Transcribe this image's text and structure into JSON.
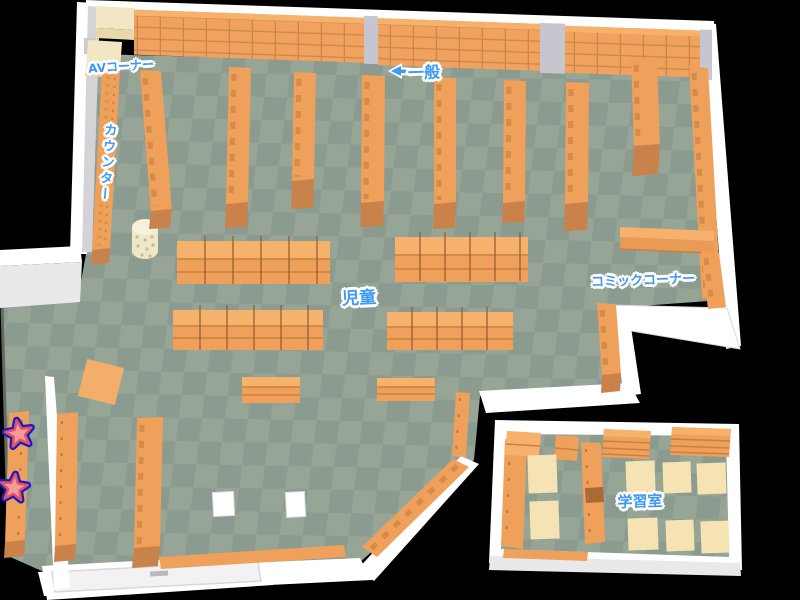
{
  "areas": {
    "av_corner": {
      "label": "AVコーナー"
    },
    "general": {
      "label": "一般"
    },
    "counter": {
      "label": "カウンター"
    },
    "children": {
      "label": "児童"
    },
    "comic_corner": {
      "label": "コミックコーナー"
    },
    "study_room": {
      "label": "学習室"
    }
  },
  "markers": [
    {
      "id": "star-1",
      "icon": "star-icon",
      "fill": "#F99A9A",
      "inner_border": "#E2555E",
      "outer_border": "#1A1AC9"
    },
    {
      "id": "star-2",
      "icon": "star-icon",
      "fill": "#F99A9A",
      "inner_border": "#E2555E",
      "outer_border": "#1A1AC9"
    }
  ],
  "icons": {
    "general_pointer": "left-arrow-icon",
    "marker_shape": "star-icon"
  },
  "colors": {
    "background": "#000000",
    "wall": "#FFFFFF",
    "wall_shade": "#D4D4D8",
    "pillar": "#C6C6CE",
    "floor_light": "#97A597",
    "floor_dark": "#8B9B8F",
    "shelf": "#EFA05A",
    "shelf_top": "#F6B26C",
    "shelf_front": "#C9824A",
    "av_shelf": "#F2E6C4",
    "desk": "#F5E3B3",
    "label_text": "#3E9AF2",
    "label_outline": "#FFFFFF"
  }
}
